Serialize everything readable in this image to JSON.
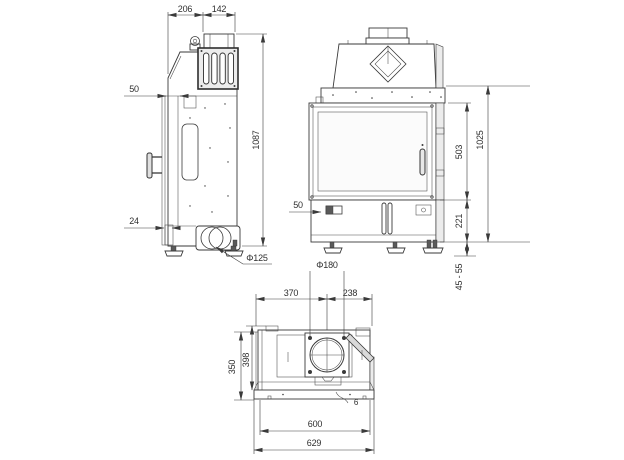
{
  "colors": {
    "background": "#ffffff",
    "line": "#3a3a3a",
    "text": "#2f2f2f",
    "panel": "#ececec"
  },
  "side_view": {
    "dims": {
      "top_depth_front": "206",
      "top_depth_flue": "142",
      "front_offset": "50",
      "total_height": "1087",
      "bottom_offset": "24",
      "rear_flue_diameter": "Φ125"
    }
  },
  "front_view": {
    "dims": {
      "glass_height": "503",
      "body_height": "1025",
      "base_height": "221",
      "feet_adjust_range": "45 - 55",
      "latch_offset": "50"
    }
  },
  "top_view": {
    "dims": {
      "flue_diameter": "Φ180",
      "left_to_flue_center": "370",
      "flue_center_to_right": "238",
      "depth_rear": "398",
      "depth_front": "350",
      "body_width": "600",
      "overall_width": "629",
      "cable_note": "6"
    }
  }
}
